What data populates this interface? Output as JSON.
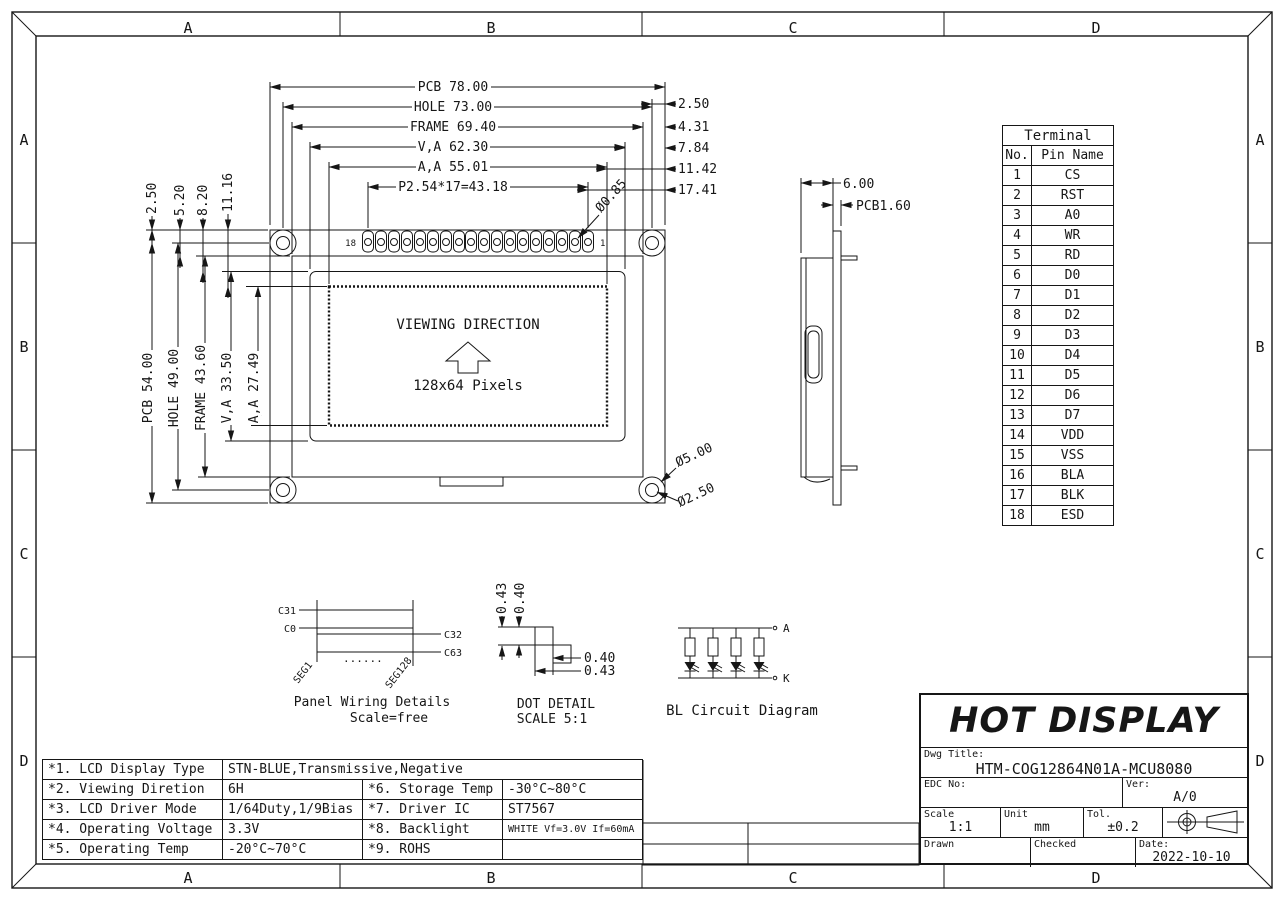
{
  "border": {
    "zones": [
      "A",
      "B",
      "C",
      "D"
    ]
  },
  "front_view": {
    "top_dims": [
      "PCB 78.00",
      "HOLE 73.00",
      "FRAME 69.40",
      "V,A 62.30",
      "A,A 55.01",
      "P2.54*17=43.18"
    ],
    "right_dims": [
      "2.50",
      "4.31",
      "7.84",
      "11.42",
      "17.41"
    ],
    "left_dims": [
      "PCB 54.00",
      "HOLE 49.00",
      "FRAME 43.60",
      "V,A 33.50",
      "A,A 27.49"
    ],
    "offset_dims": [
      "2.50",
      "5.20",
      "8.20",
      "11.16"
    ],
    "pin_hole_dia": "Ø0.85",
    "hole_outer_dia": "Ø5.00",
    "hole_inner_dia": "Ø2.50",
    "pin_last": "18",
    "pin_first": "1",
    "screen_line1": "VIEWING DIRECTION",
    "screen_line2": "128x64 Pixels"
  },
  "side_view": {
    "thickness": "6.00",
    "pcb_thickness": "PCB1.60"
  },
  "wiring_detail": {
    "label_c31": "C31",
    "label_c0": "C0",
    "label_c32": "C32",
    "label_c63": "C63",
    "seg_left": "SEG1",
    "seg_right": "SEG128",
    "dots": "......",
    "caption1": "Panel Wiring Details",
    "caption2": "Scale=free"
  },
  "dot_detail": {
    "v_dim1": "0.43",
    "v_dim2": "0.40",
    "h_dim1": "0.40",
    "h_dim2": "0.43",
    "caption1": "DOT DETAIL",
    "caption2": "SCALE 5:1"
  },
  "bl_circuit": {
    "anode": "A",
    "cathode": "K",
    "caption": "BL Circuit Diagram"
  },
  "terminal_table": {
    "title": "Terminal",
    "col_no": "No.",
    "col_name": "Pin Name",
    "rows": [
      {
        "no": "1",
        "name": "CS"
      },
      {
        "no": "2",
        "name": "RST"
      },
      {
        "no": "3",
        "name": "A0"
      },
      {
        "no": "4",
        "name": "WR"
      },
      {
        "no": "5",
        "name": "RD"
      },
      {
        "no": "6",
        "name": "D0"
      },
      {
        "no": "7",
        "name": "D1"
      },
      {
        "no": "8",
        "name": "D2"
      },
      {
        "no": "9",
        "name": "D3"
      },
      {
        "no": "10",
        "name": "D4"
      },
      {
        "no": "11",
        "name": "D5"
      },
      {
        "no": "12",
        "name": "D6"
      },
      {
        "no": "13",
        "name": "D7"
      },
      {
        "no": "14",
        "name": "VDD"
      },
      {
        "no": "15",
        "name": "VSS"
      },
      {
        "no": "16",
        "name": "BLA"
      },
      {
        "no": "17",
        "name": "BLK"
      },
      {
        "no": "18",
        "name": "ESD"
      }
    ]
  },
  "spec_table": {
    "rows": [
      {
        "label": "*1. LCD Display Type",
        "value": "STN-BLUE,Transmissive,Negative",
        "label2": "",
        "value2": ""
      },
      {
        "label": "*2. Viewing Diretion",
        "value": "6H",
        "label2": "*6. Storage Temp",
        "value2": "-30°C~80°C"
      },
      {
        "label": "*3. LCD Driver Mode",
        "value": "1/64Duty,1/9Bias",
        "label2": "*7. Driver IC",
        "value2": "ST7567"
      },
      {
        "label": "*4. Operating Voltage",
        "value": "3.3V",
        "label2": "*8. Backlight",
        "value2": "WHITE Vf=3.0V If=60mA"
      },
      {
        "label": "*5. Operating Temp",
        "value": "-20°C~70°C",
        "label2": "*9. ROHS",
        "value2": ""
      }
    ]
  },
  "title_block": {
    "company": "HOT DISPLAY",
    "dwg_title_label": "Dwg Title:",
    "dwg_title": "HTM-COG12864N01A-MCU8080",
    "edc_label": "EDC No:",
    "ver_label": "Ver:",
    "ver": "A/0",
    "scale_label": "Scale",
    "scale": "1:1",
    "unit_label": "Unit",
    "unit": "mm",
    "tol_label": "Tol.",
    "tol": "±0.2",
    "drawn_label": "Drawn",
    "checked_label": "Checked",
    "date_label": "Date:",
    "date": "2022-10-10"
  }
}
